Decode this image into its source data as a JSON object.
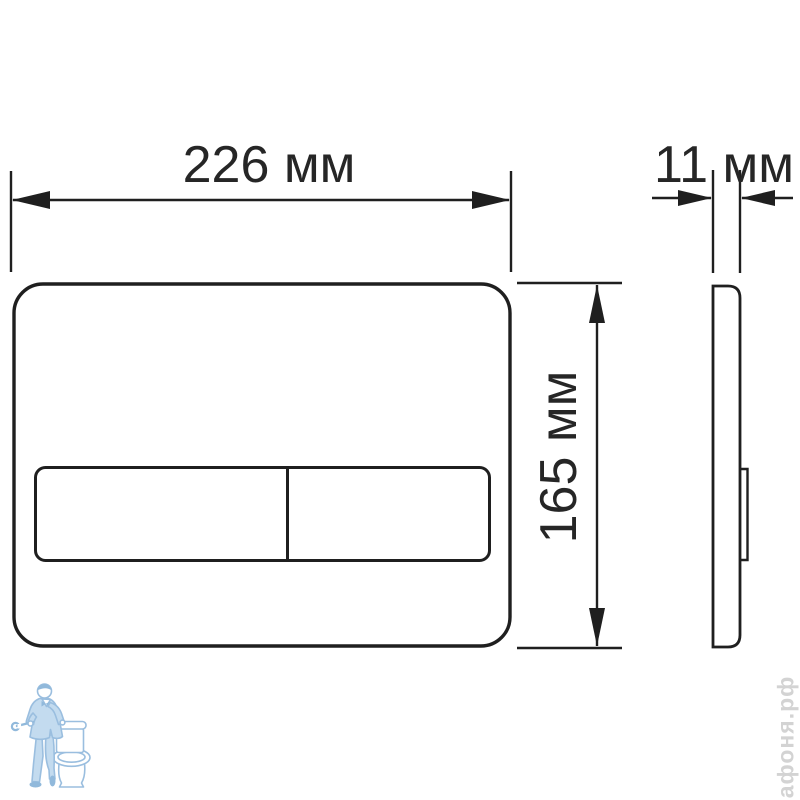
{
  "drawing": {
    "subject": "toilet-flush-plate-technical-drawing",
    "views": [
      "front-view",
      "side-view"
    ],
    "background_color": "#ffffff",
    "line_color": "#1f1f1f",
    "text_color": "#262626"
  },
  "dimensions": {
    "width": {
      "value": 226,
      "unit": "мм",
      "label": "226 мм"
    },
    "depth": {
      "value": 11,
      "unit": "мм",
      "label": "11 мм"
    },
    "height": {
      "value": 165,
      "unit": "мм",
      "label": "165 мм"
    }
  },
  "watermark": {
    "text": "афоня.рф",
    "text_color": "#d3d3d3",
    "logo": "plumber-leaning-on-toilet",
    "logo_stroke_color": "#90b8dc",
    "logo_fill_color": "#bdd8ee",
    "logo_dark_color": "#86b2d8"
  }
}
